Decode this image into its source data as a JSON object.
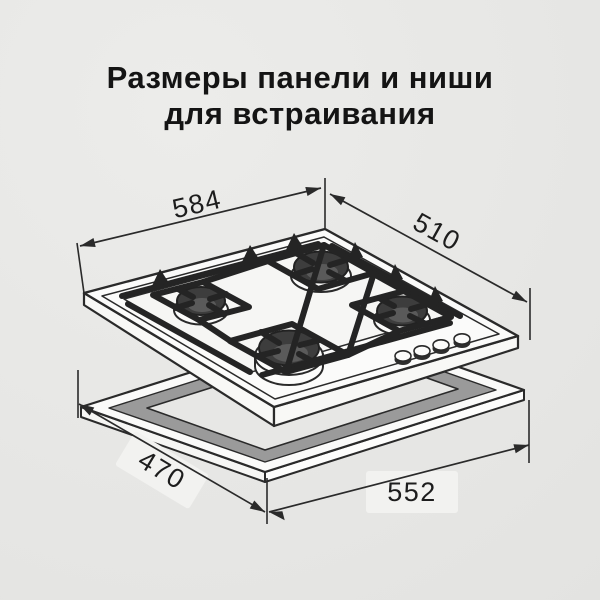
{
  "title": {
    "line1": "Размеры панели и ниши",
    "line2": "для встраивания"
  },
  "diagram": {
    "dimensions": {
      "panel_width": "584",
      "panel_depth": "510",
      "niche_depth": "470",
      "niche_width": "552"
    },
    "colors": {
      "background": "#e7e7e5",
      "outline": "#2a2a2a",
      "grate": "#242424",
      "burner_cap": "#3d3d3d",
      "surface_white": "#fbfbfa",
      "niche_inner_band": "#9a9a9a",
      "label_box": "#f2f2f0",
      "text": "#141414"
    }
  }
}
